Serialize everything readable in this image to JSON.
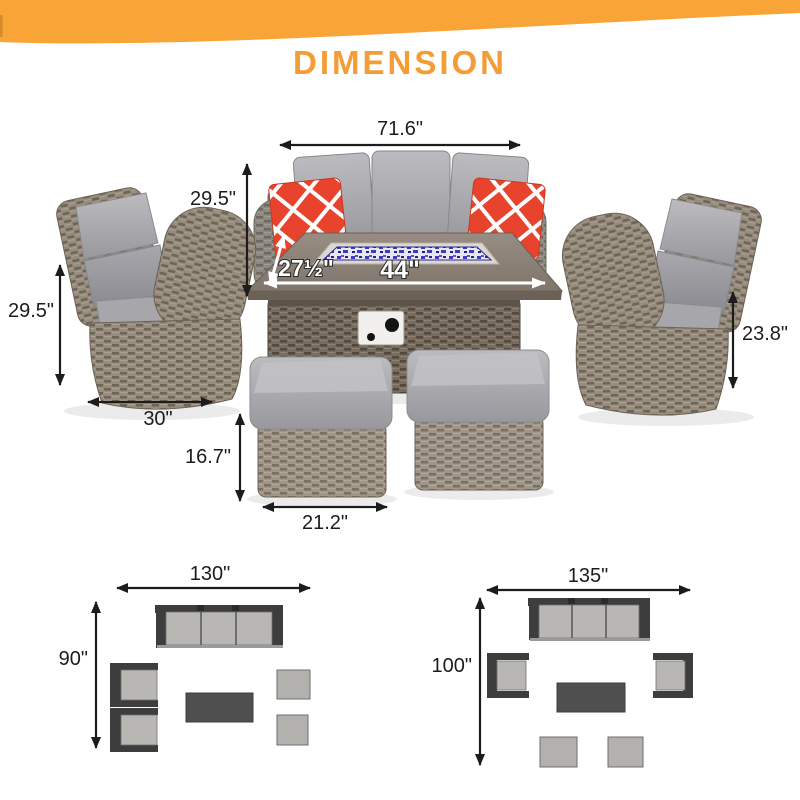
{
  "banner": {
    "title": "DIMENSION"
  },
  "dims": {
    "sofa_width": "71.6\"",
    "sofa_height": "29.5\"",
    "table_depth": "27½\"",
    "table_width": "44\"",
    "chair_height": "29.5\"",
    "chair_width": "30\"",
    "right_chair_height": "23.8\"",
    "ottoman_height": "16.7\"",
    "ottoman_width": "21.2\""
  },
  "layouts": [
    {
      "width_label": "130\"",
      "depth_label": "90\""
    },
    {
      "width_label": "135\"",
      "depth_label": "100\""
    }
  ],
  "colors": {
    "accent_orange": "#f8a437",
    "title_orange": "#f49c36",
    "pillow_red": "#e8432d",
    "fire_glass_blue": "#3f3ac0",
    "cushion_gray": "#aeaeb2",
    "wicker_gray": "#8d8a82",
    "wicker_brown": "#978d7f",
    "arrow_black": "#1c1c1c",
    "plan_frame_dark": "#3d3d3d",
    "plan_cushion_gray": "#b9b7b4"
  }
}
